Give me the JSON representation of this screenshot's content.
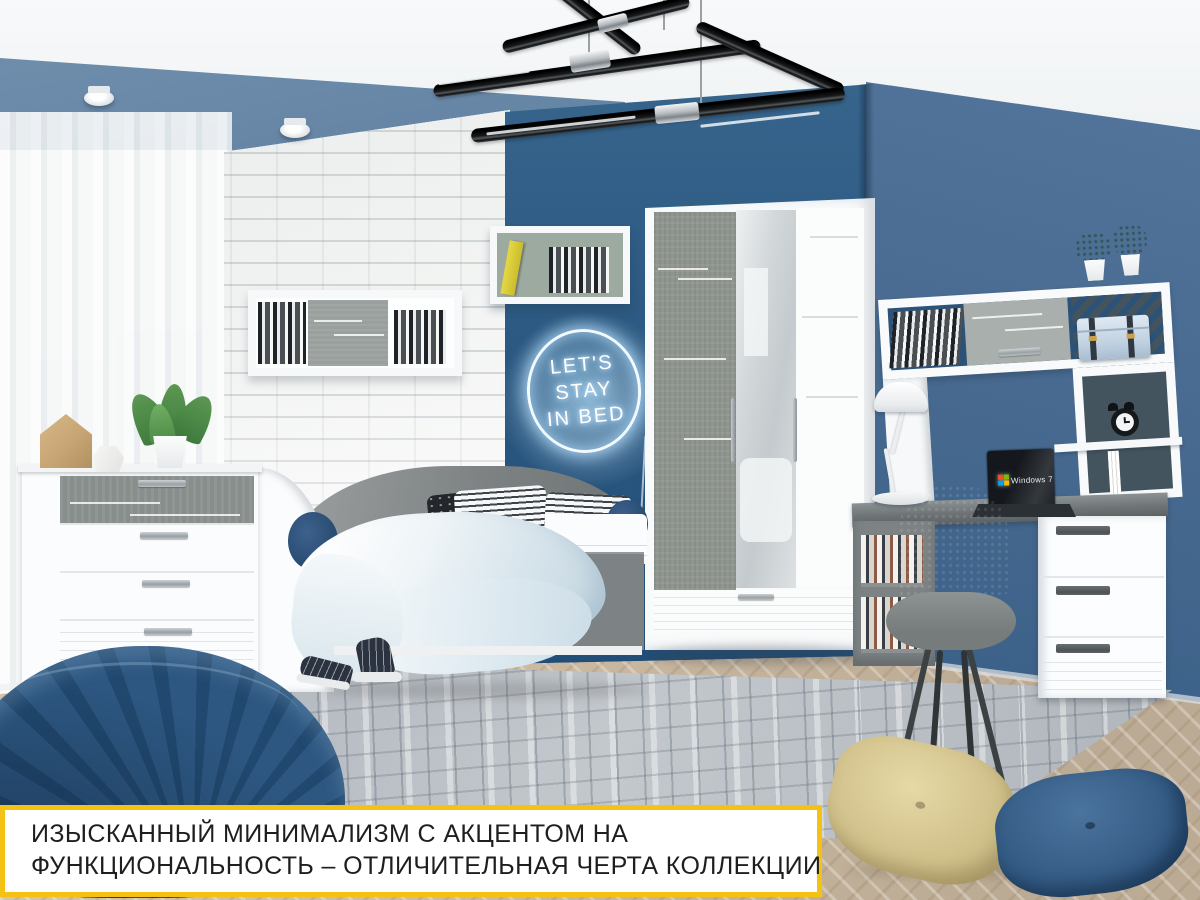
{
  "caption": {
    "line1": "ИЗЫСКАННЫЙ МИНИМАЛИЗМ С АКЦЕНТОМ НА",
    "line2": "ФУНКЦИОНАЛЬНОСТЬ – ОТЛИЧИТЕЛЬНАЯ ЧЕРТА КОЛЛЕКЦИИ"
  },
  "neon_sign": {
    "line1": "LET'S",
    "line2": "STAY",
    "line3": "IN BED"
  },
  "laptop_screen": {
    "os_label": "Windows 7"
  },
  "colors": {
    "accent_yellow": "#f3c212",
    "caption_text": "#1e1e1e",
    "wall_back_blue": "#2b5a82",
    "wall_right_blue": "#47698f",
    "soffit_blue": "#557698",
    "brick_white": "#f3f5f4",
    "floor_wood": "#cbb9a2",
    "rug_gray": "#b4bac0",
    "furniture_white": "#fbfcfd",
    "furniture_gray_fabric": "#8f958f",
    "desk_gray": "#757c7e",
    "pouf_navy": "#2a5480",
    "pillow_yellow": "#d4c48e",
    "pillow_blue": "#3a6189",
    "neon_glow": "#cfeaff"
  }
}
